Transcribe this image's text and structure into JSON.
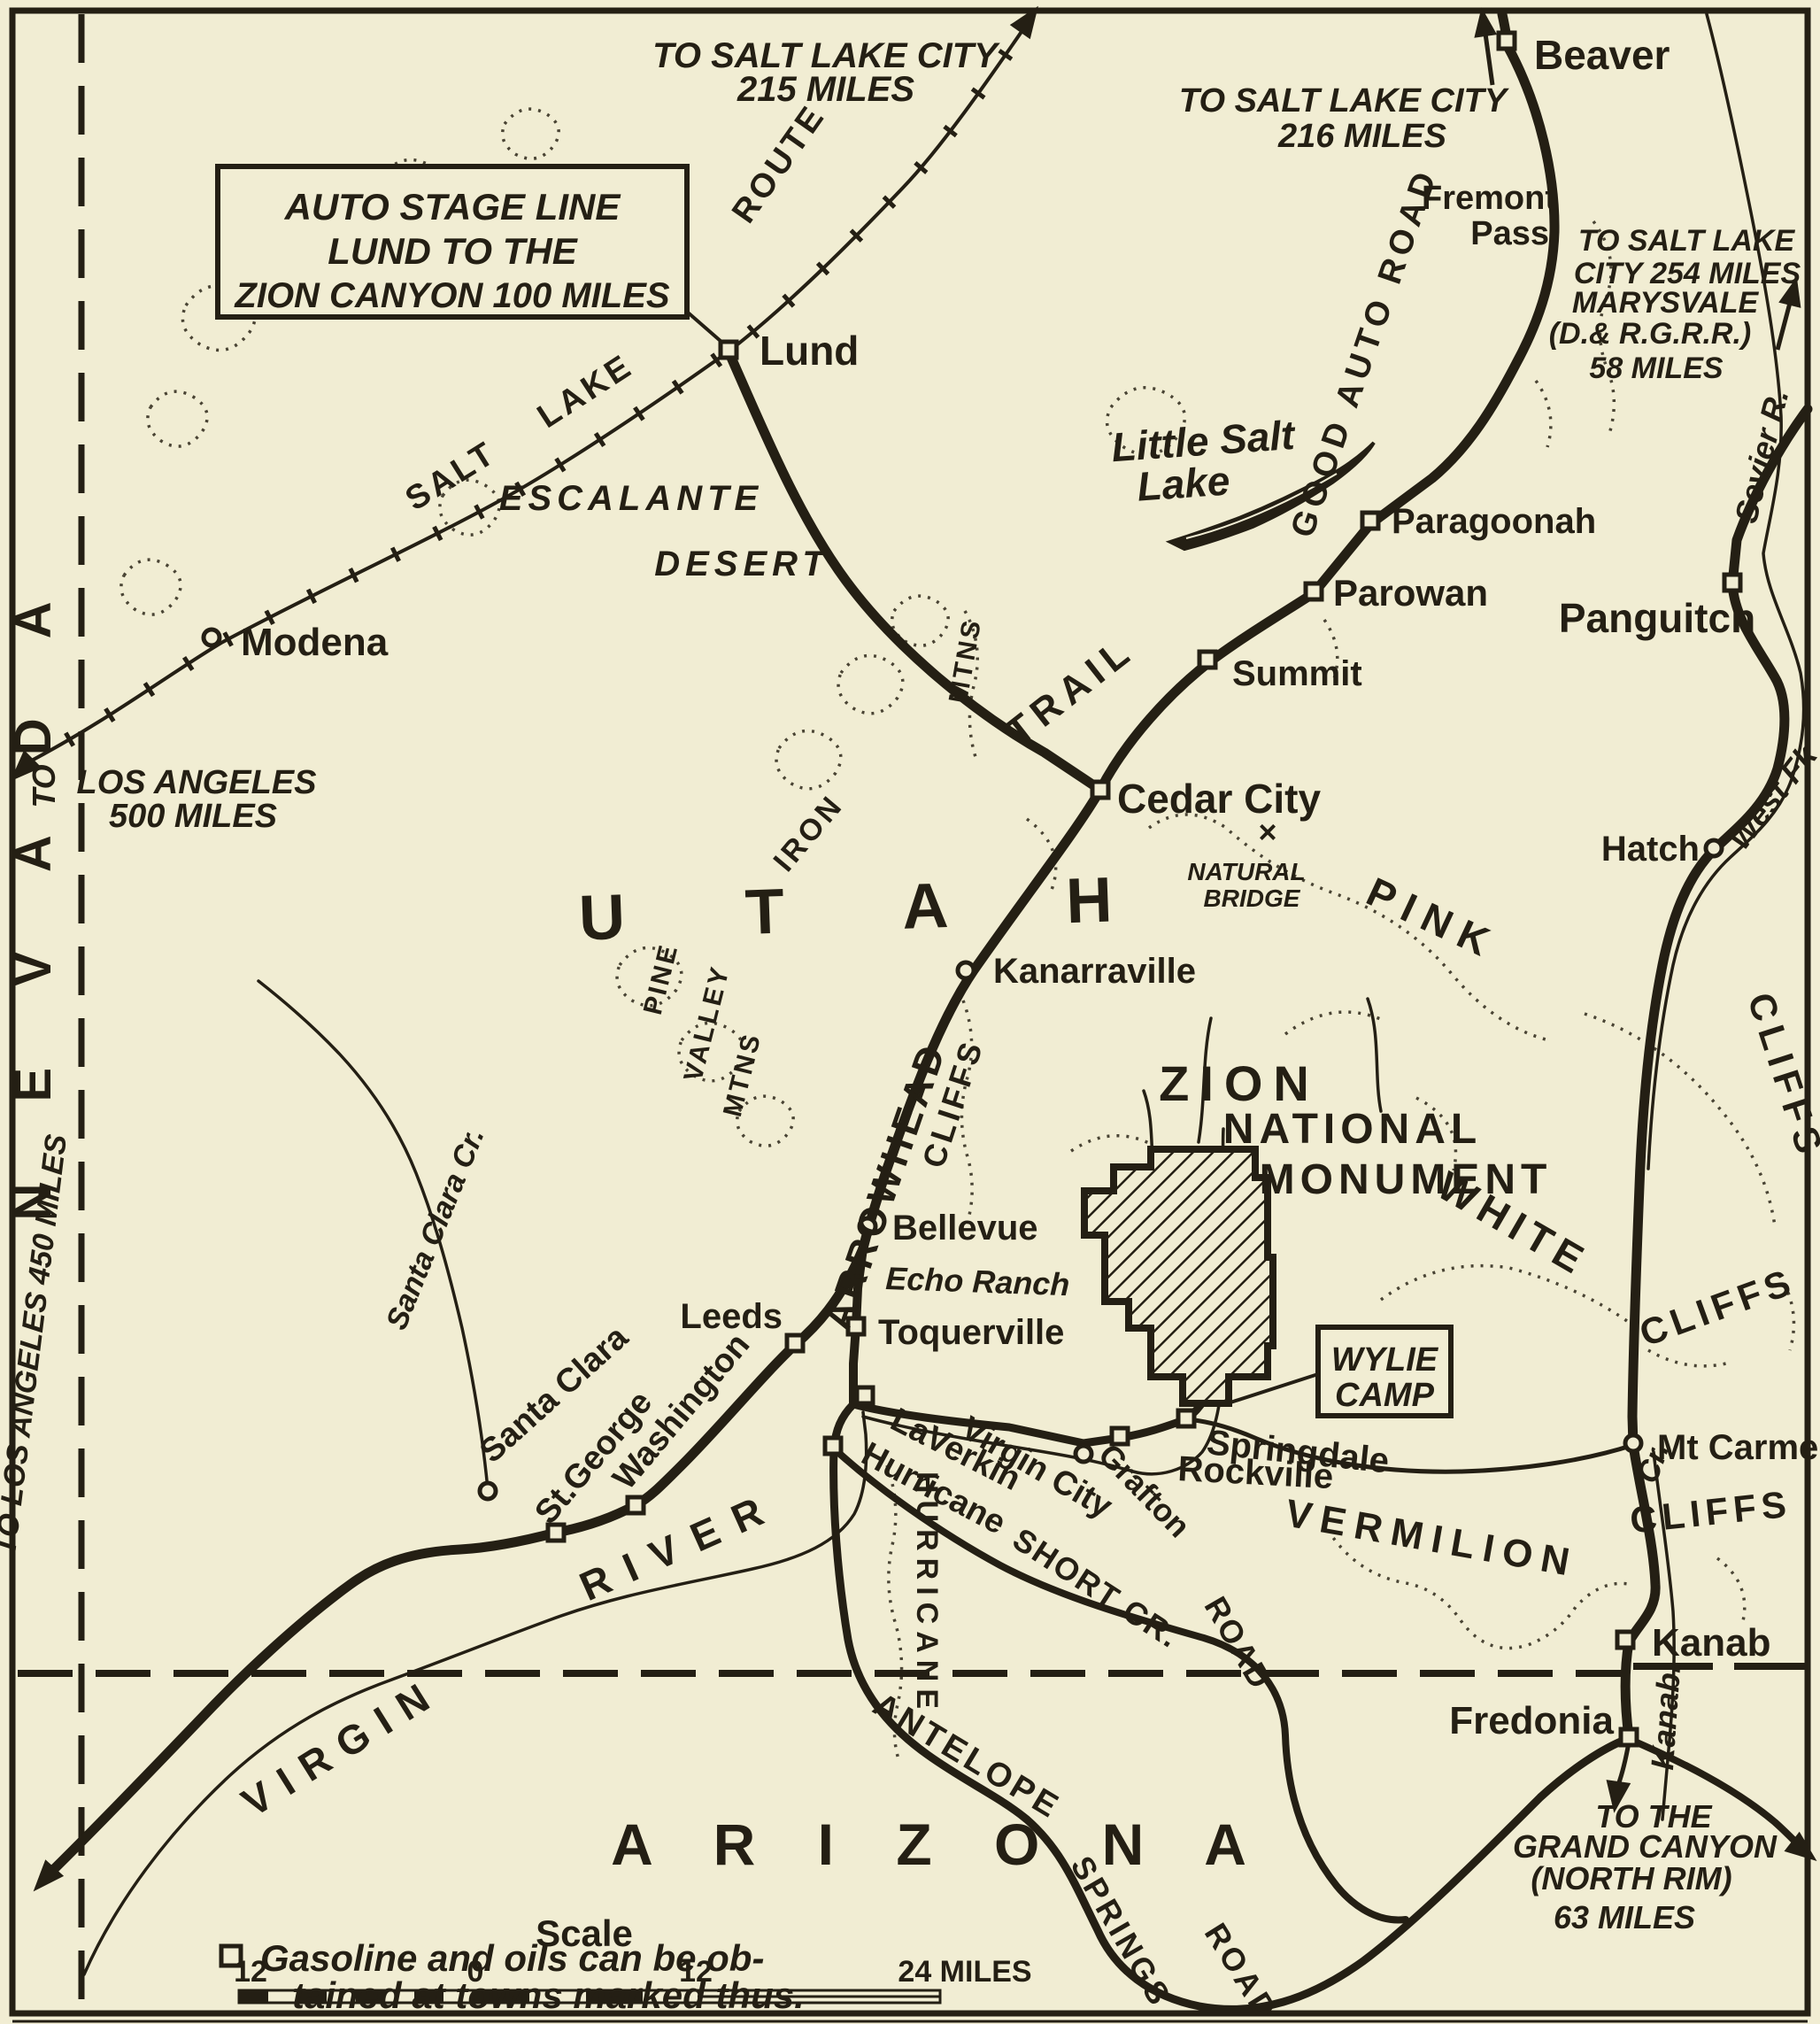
{
  "map_title_box": {
    "line1": "AUTO STAGE LINE",
    "line2": "LUND TO THE",
    "line3": "ZION CANYON 100 MILES"
  },
  "regions": {
    "utah": "U T A H",
    "arizona": "A R I Z O N A",
    "nevada": "N E V A D A"
  },
  "park": {
    "line1": "ZION",
    "line2": "NATIONAL",
    "line3": "MONUMENT"
  },
  "camp": {
    "line1": "WYLIE",
    "line2": "CAMP"
  },
  "towns": {
    "beaver": "Beaver",
    "lund": "Lund",
    "modena": "Modena",
    "paragoonah": "Paragoonah",
    "parowan": "Parowan",
    "summit": "Summit",
    "panguitch": "Panguitch",
    "cedar_city": "Cedar City",
    "hatch": "Hatch",
    "kanarraville": "Kanarraville",
    "bellevue": "Bellevue",
    "echo_ranch": "Echo Ranch",
    "toquerville": "Toquerville",
    "leeds": "Leeds",
    "washington": "Washington",
    "st_george": "St.George",
    "santa_clara": "Santa Clara",
    "laverkin": "LaVerkin",
    "hurricane": "Hurricane",
    "virgin_city": "Virgin City",
    "grafton": "Grafton",
    "rockville": "Rockville",
    "springdale": "Springdale",
    "mt_carmel": "Mt Carmel",
    "kanab": "Kanab",
    "fredonia": "Fredonia",
    "fremont_1": "Fremont",
    "fremont_2": "Pass"
  },
  "routes": {
    "salt": "SALT",
    "lake": "LAKE",
    "route": "ROUTE",
    "good_auto_road": "GOOD AUTO ROAD",
    "arrowhead": "ARROWHEAD",
    "trail": "TRAIL",
    "antelope": "ANTELOPE",
    "springs": "SPRINGS",
    "road_antelope": "ROAD",
    "short_cr": "SHORT CR.",
    "road_short": "ROAD",
    "hurricane_vertical": "HURRICANE"
  },
  "notes": {
    "slc215_1": "TO SALT LAKE CITY",
    "slc215_2": "215 MILES",
    "slc216_1": "TO SALT LAKE CITY",
    "slc216_2": "216 MILES",
    "marysvale_1": "TO SALT LAKE",
    "marysvale_2": "CITY 254 MILES",
    "marysvale_3": "MARYSVALE",
    "marysvale_4": "(D.& R.G.R.R.)",
    "marysvale_5": "58 MILES",
    "la500_to": "TO",
    "la500_1": "LOS ANGELES",
    "la500_2": "500 MILES",
    "la450": "TO LOS ANGELES 450 MILES",
    "grand1": "TO THE",
    "grand2": "GRAND CANYON",
    "grand3": "(NORTH RIM)",
    "grand4": "63 MILES"
  },
  "features": {
    "escalante": "ESCALANTE",
    "desert": "DESERT",
    "little_salt_1": "Little Salt",
    "little_salt_2": "Lake",
    "iron": "IRON",
    "mtns_a": "MTNS",
    "pine": "PINE",
    "valley": "VALLEY",
    "mtns_b": "MTNS",
    "pink": "PINK",
    "pink_cliffs": "CLIFFS",
    "white": "WHITE",
    "white_cliffs": "CLIFFS",
    "vermilion": "VERMILION",
    "vermilion_cliffs": "CLIFFS",
    "hurricane_cliffs_label": "CLIFFS",
    "natural_x": "×",
    "natural_1": "NATURAL",
    "natural_2": "BRIDGE",
    "sevier": "Sevier R.",
    "west_fk": "West Fk",
    "santa_clara_cr": "Santa Clara Cr.",
    "kanab_cr_1": "Cr.",
    "kanab_cr_2": "Kanab.",
    "virgin": "VIRGIN",
    "river": "RIVER"
  },
  "scale": {
    "title": "Scale",
    "left12": "12",
    "zero": "0",
    "right12": "12",
    "right24": "24 MILES"
  },
  "legend": {
    "line1": "Gasoline and oils can be ob-",
    "line2": "tained at towns marked thus."
  },
  "colors": {
    "paper": "#f1edd3",
    "ink": "#241f14"
  }
}
